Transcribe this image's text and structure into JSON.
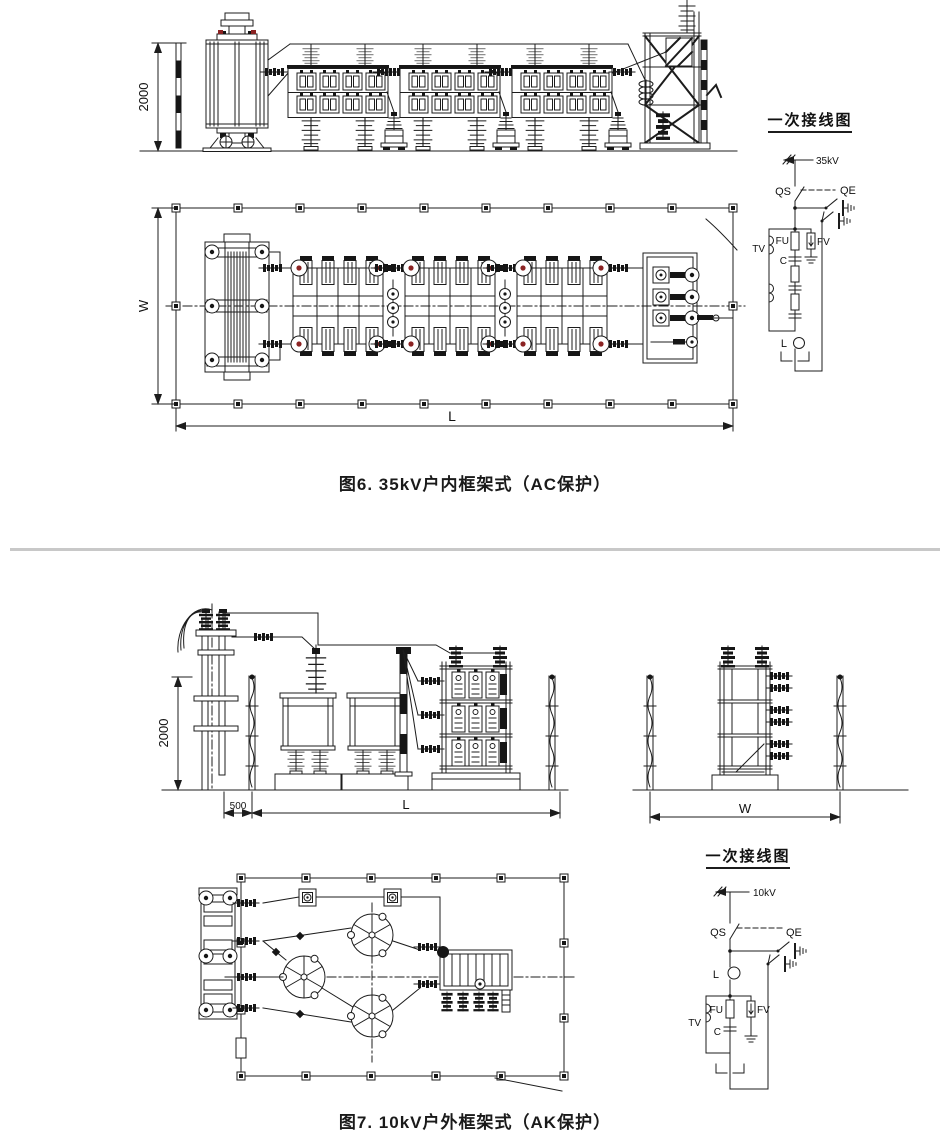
{
  "figure6": {
    "caption": "图6. 35kV户内框架式（AC保护）",
    "elevation": {
      "height_dim": "2000"
    },
    "plan": {
      "width_dim": "W",
      "length_dim": "L"
    },
    "wiring": {
      "title": "一次接线图",
      "incoming": "35kV",
      "disconnector": "QS",
      "earth_switch": "QE",
      "voltage_transformer": "TV",
      "fuse": "FU",
      "capacitor": "C",
      "arrester": "FV",
      "reactor": "L"
    }
  },
  "figure7": {
    "caption": "图7. 10kV户外框架式（AK保护）",
    "elevation": {
      "height_dim": "2000",
      "offset_dim": "500",
      "length_dim": "L"
    },
    "side_view": {
      "width_dim": "W"
    },
    "wiring": {
      "title": "一次接线图",
      "incoming": "10kV",
      "disconnector": "QS",
      "earth_switch": "QE",
      "reactor": "L",
      "voltage_transformer": "TV",
      "fuse": "FU",
      "capacitor": "C",
      "arrester": "FV"
    }
  },
  "colors": {
    "line": "#1c1c1c",
    "divider": "#c8c8c8",
    "accent_red": "#8b2323"
  }
}
